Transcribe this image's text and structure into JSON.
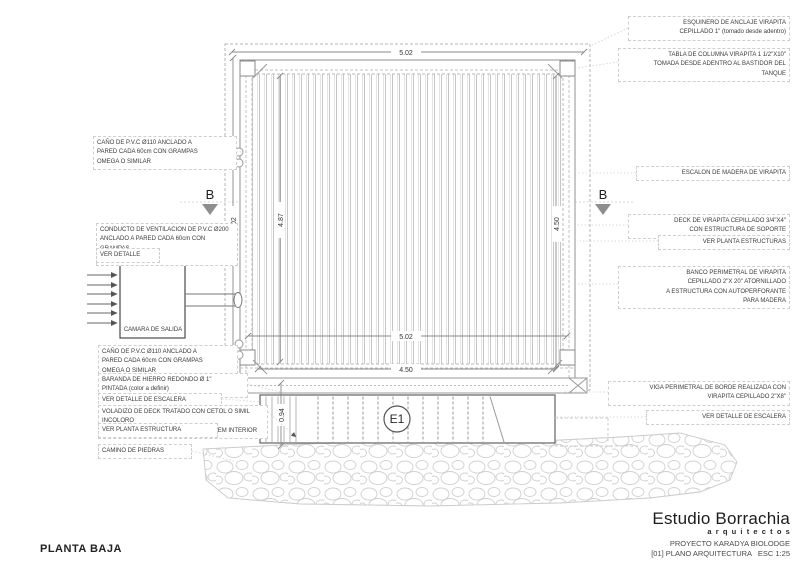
{
  "plan": {
    "title": "PLANTA BAJA",
    "section_label": "B",
    "stairs_label": "E1",
    "camara_label": "CAMARA DE SALIDA",
    "dims": {
      "top": "5.02",
      "left": "5.02",
      "left_inner": "4.87",
      "right": "4.50",
      "bottom": "5.02",
      "bottom_inner": "4.50",
      "stair": "0.94"
    },
    "left_labels": [
      "CAÑO DE P.V.C Ø110 ANCLADO A\nPARED CADA 60cm CON GRAMPAS\nOMEGA O SIMILAR",
      "CONDUCTO DE VENTILACION DE P.V.C Ø200\nANCLADO A PARED CADA 60cm CON GRAMPAS\nOMEGA O SIMILAR",
      "VER DETALLE",
      "CAÑO DE P.V.C Ø110 ANCLADO A\nPARED CADA 60cm CON GRAMPAS\nOMEGA O SIMILAR",
      "BARANDA DE HIERRO REDONDO Ø 1\"\nPINTADA (color a definir)",
      "VER DETALLE DE ESCALERA",
      "VOLADIZO DE DECK TRATADO CON CETOL O SIMIL INCOLORO\nVIRAPITA CEPILLADO 1\" X 4 SENTIDO IDEM INTERIOR",
      "VER PLANTA ESTRUCTURA",
      "CAMINO DE PIEDRAS"
    ],
    "right_labels": [
      "ESQUINERO DE ANCLAJE VIRAPITA\nCEPILLADO 1\" (tomado desde adentro)",
      "TABLA DE COLUMNA VIRAPITA 1 1/2\"X10\"\nTOMADA DESDE ADENTRO AL BASTIDOR DEL\nTANQUE",
      "ESCALON DE MADERA DE VIRAPITA",
      "DECK DE VIRAPITA CEPILLADO 3/4\"X4\"\nCON ESTRUCTURA DE SOPORTE",
      "VER PLANTA ESTRUCTURAS",
      "BANCO PERIMETRAL DE VIRAPITA\nCEPILLADO 2\"X 20\" ATORNILLADO\nA ESTRUCTURA CON AUTOPERFORANTE\nPARA MADERA",
      "VIGA PERIMETRAL DE BORDE REALIZADA CON\nVIRAPITA CEPILLADO 2\"X8\"",
      "VER DETALLE DE ESCALERA"
    ]
  },
  "titleblock": {
    "studio": "Estudio Borrachia",
    "studio_sub": "arquitectos",
    "project": "PROYECTO KARADYA BIOLODGE",
    "sheet": "[01] PLANO ARQUITECTURA   ESC 1:25"
  }
}
